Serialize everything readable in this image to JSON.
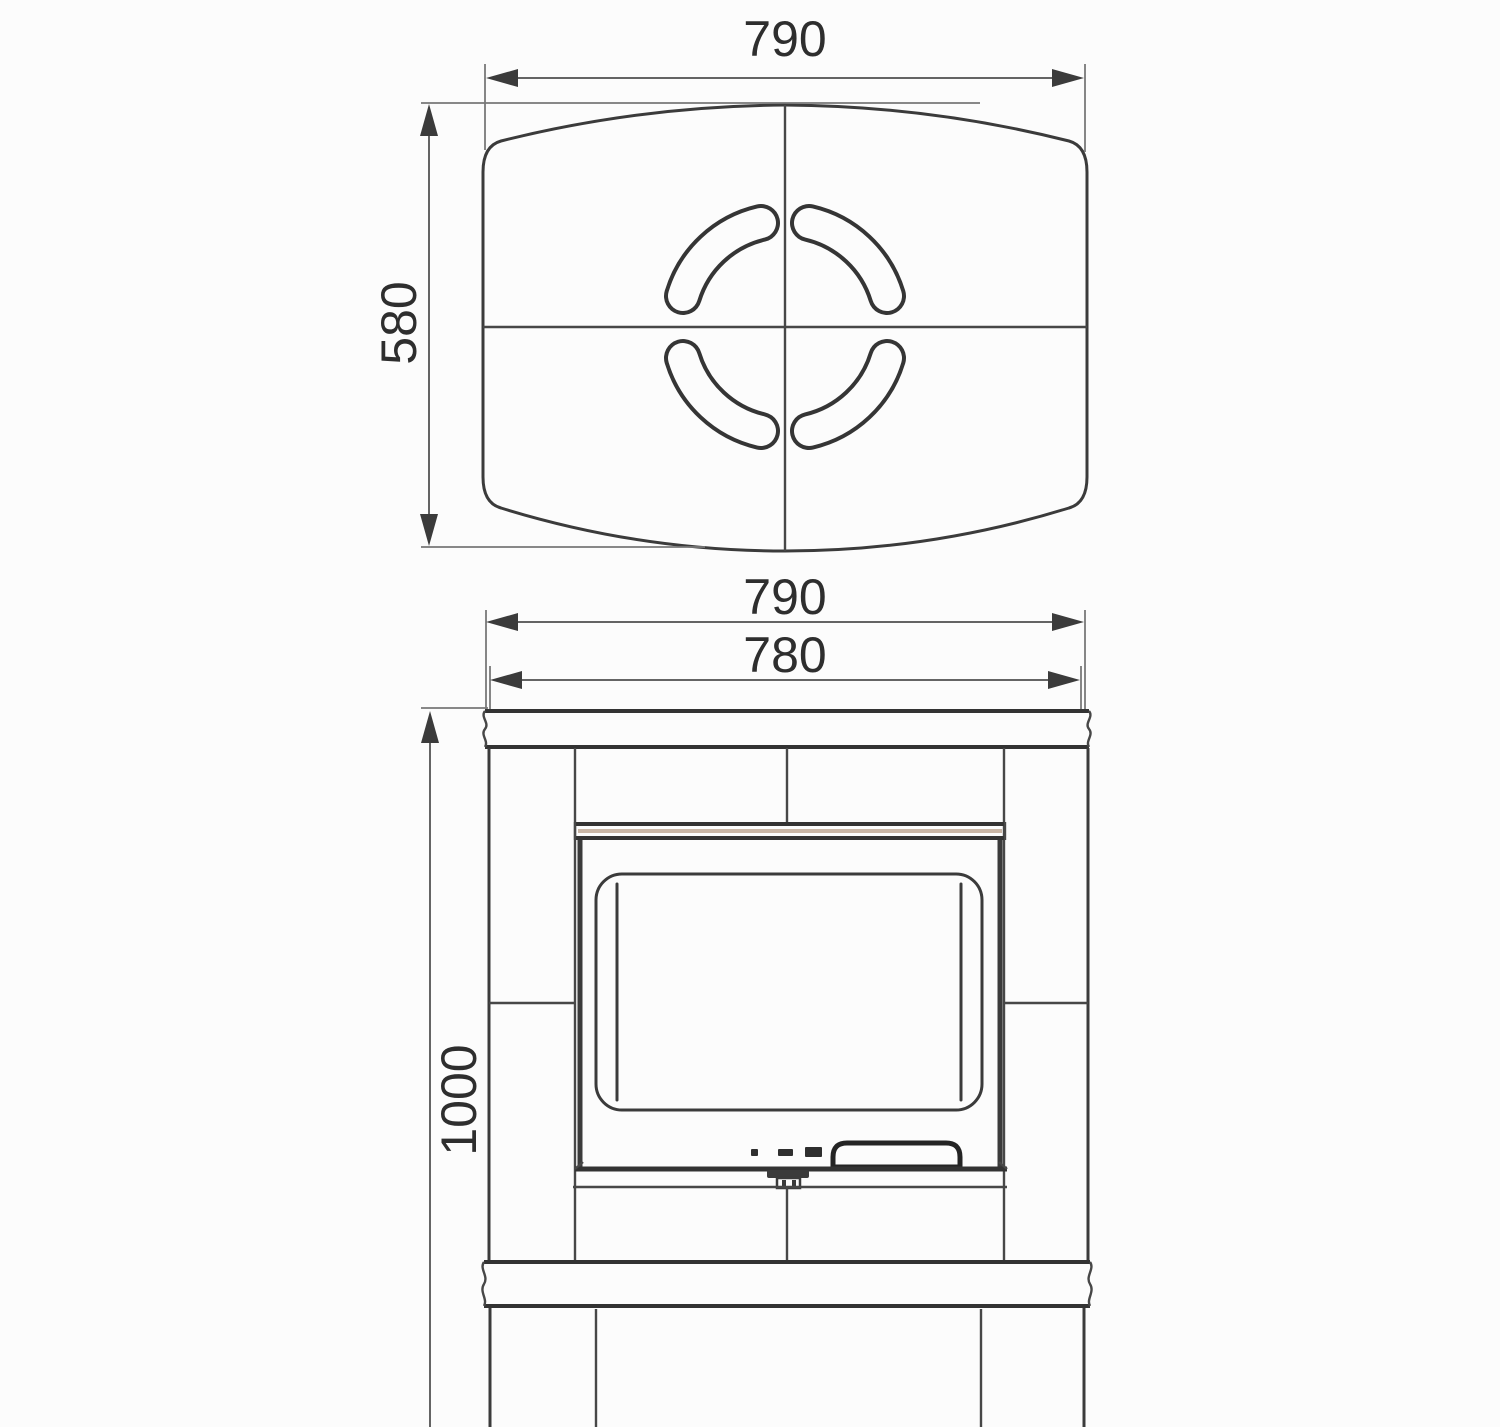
{
  "drawing": {
    "type": "technical dimension drawing",
    "subject": "stove top view and front view"
  },
  "colors": {
    "line": "#3b3b3b",
    "dim_line": "#646464",
    "text": "#2e2e2e",
    "background": "#fcfcfc",
    "door_bar_stripe": "#c9b6a6"
  },
  "top_view": {
    "width": "790",
    "depth": "580"
  },
  "front_view": {
    "width_top": "790",
    "width_body": "780",
    "height": "1000"
  }
}
